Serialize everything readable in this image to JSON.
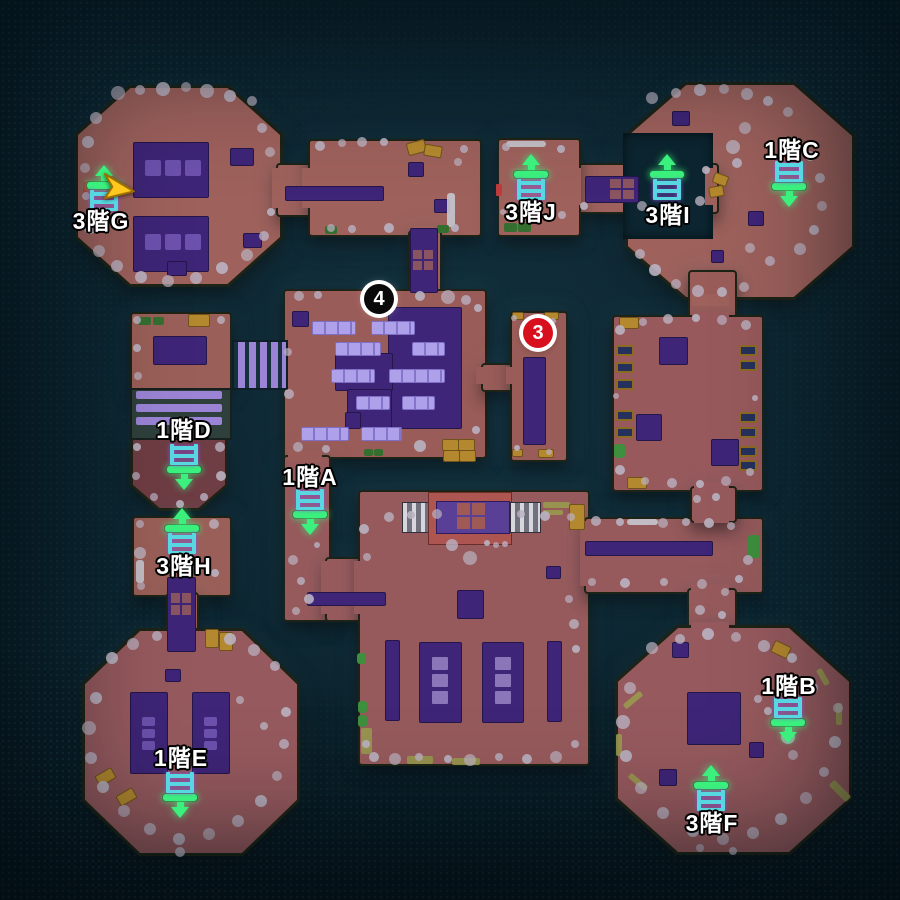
{
  "map": {
    "ladders": [
      {
        "id": "g",
        "label": "3階G",
        "direction": "up",
        "icon": {
          "x": 104,
          "y": 185
        },
        "label_pos": {
          "x": 101,
          "y": 219
        }
      },
      {
        "id": "j",
        "label": "3階J",
        "direction": "up",
        "icon": {
          "x": 531,
          "y": 174
        },
        "label_pos": {
          "x": 531,
          "y": 210
        }
      },
      {
        "id": "i",
        "label": "3階I",
        "direction": "up",
        "icon": {
          "x": 667,
          "y": 174
        },
        "label_pos": {
          "x": 668,
          "y": 213
        }
      },
      {
        "id": "c",
        "label": "1階C",
        "direction": "down",
        "icon": {
          "x": 789,
          "y": 186
        },
        "label_pos": {
          "x": 792,
          "y": 148
        }
      },
      {
        "id": "d",
        "label": "1階D",
        "direction": "down",
        "icon": {
          "x": 184,
          "y": 469
        },
        "label_pos": {
          "x": 184,
          "y": 428
        }
      },
      {
        "id": "a",
        "label": "1階A",
        "direction": "down",
        "icon": {
          "x": 310,
          "y": 514
        },
        "label_pos": {
          "x": 310,
          "y": 475
        }
      },
      {
        "id": "h",
        "label": "3階H",
        "direction": "up",
        "icon": {
          "x": 182,
          "y": 528
        },
        "label_pos": {
          "x": 184,
          "y": 564
        }
      },
      {
        "id": "e",
        "label": "1階E",
        "direction": "down",
        "icon": {
          "x": 180,
          "y": 797
        },
        "label_pos": {
          "x": 181,
          "y": 756
        }
      },
      {
        "id": "b",
        "label": "1階B",
        "direction": "down",
        "icon": {
          "x": 788,
          "y": 722
        },
        "label_pos": {
          "x": 789,
          "y": 684
        }
      },
      {
        "id": "f",
        "label": "3階F",
        "direction": "up",
        "icon": {
          "x": 711,
          "y": 785
        },
        "label_pos": {
          "x": 712,
          "y": 821
        }
      }
    ],
    "numbered_markers": [
      {
        "number": "4",
        "style": "black",
        "x": 379,
        "y": 299
      },
      {
        "number": "3",
        "style": "red",
        "x": 538,
        "y": 333
      }
    ],
    "player": {
      "x": 114,
      "y": 186,
      "rotation_deg": 12
    }
  },
  "colors": {
    "background": "#0c2530",
    "room": "#9a5c58",
    "room_north": "#9e615c",
    "room_dark": "#6f3d44",
    "furniture_purple": "#3e2577",
    "table_lavender": "#afa0ea",
    "ladder_green": "#3bf07d",
    "ladder_rail": "#57d8e0",
    "player_arrow": "#ffc81f",
    "marker_red": "#d8101e",
    "marker_black": "#0a0a0a",
    "pebble": "#bab2c2",
    "accent_gold": "#b3882e"
  }
}
